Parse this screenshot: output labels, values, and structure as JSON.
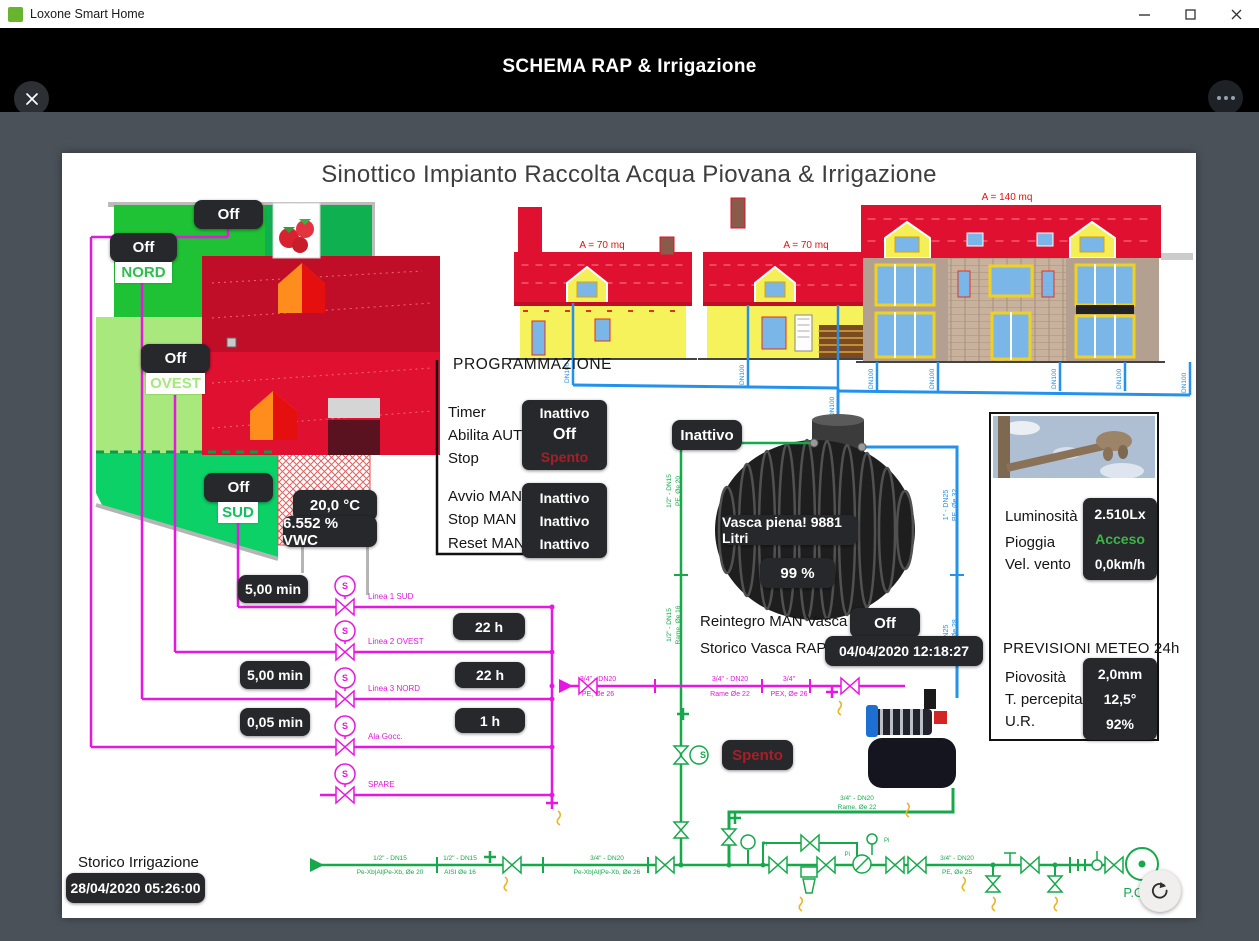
{
  "window": {
    "title": "Loxone Smart Home"
  },
  "header": {
    "title": "SCHEMA RAP & Irrigazione"
  },
  "canvas": {
    "title": "Sinottico Impianto Raccolta Acqua Piovana & Irrigazione",
    "map": {
      "top_state": "Off",
      "nord_state": "Off",
      "nord_label": "NORD",
      "ovest_state": "Off",
      "ovest_label": "OVEST",
      "sud_state": "Off",
      "sud_label": "SUD",
      "soil_temp": "20,0 °C",
      "soil_vwc": "6.552 % VWC"
    },
    "houses": {
      "area_small_1": "A = 70 mq",
      "area_small_2": "A = 70 mq",
      "area_large": "A = 140 mq",
      "downpipe_label": "DN100"
    },
    "program": {
      "title": "PROGRAMMAZIONE",
      "timer_label": "Timer",
      "timer_value": "Inattivo",
      "auto_label": "Abilita AUTO",
      "auto_value": "Off",
      "stop_label": "Stop",
      "stop_value": "Spento",
      "avvio_label": "Avvio MAN",
      "avvio_value": "Inattivo",
      "stopman_label": "Stop MAN",
      "stopman_value": "Inattivo",
      "reset_label": "Reset MAN",
      "reset_value": "Inattivo"
    },
    "tank": {
      "inlet_state": "Inattivo",
      "level_text": "Vasca piena! 9881 Litri",
      "level_percent": "99 %",
      "reintegro_label": "Reintegro MAN Vasca",
      "reintegro_value": "Off",
      "storico_label": "Storico Vasca RAP",
      "storico_value": "04/04/2020 12:18:27"
    },
    "weather": {
      "lum_label": "Luminosità",
      "lum_value": "2.510Lx",
      "rain_label": "Pioggia",
      "rain_value": "Acceso",
      "wind_label": "Vel. vento",
      "wind_value": "0,0km/h",
      "forecast_title": "PREVISIONI METEO 24h",
      "rain24_label": "Piovosità",
      "rain24_value": "2,0mm",
      "temp_label": "T. percepita",
      "temp_value": "12,5°",
      "hum_label": "U.R.",
      "hum_value": "92%"
    },
    "irrigation": {
      "valve_letter": "S",
      "line1": "Linea 1 SUD",
      "line2": "Linea 2 OVEST",
      "line3": "Linea 3 NORD",
      "line4": "Ala Gocc.",
      "line5": "SPARE",
      "dur1": "5,00 min",
      "cnt1": "22 h",
      "dur3": "5,00 min",
      "cnt3": "22 h",
      "dur4": "0,05 min",
      "cnt4": "1 h",
      "pump_state": "Spento"
    },
    "pipes": {
      "gauge": "Pi",
      "tank_in_a1": "1/2\" - DN15",
      "tank_in_a2": "PE, Øe 20",
      "tank_in_b1": "1/2\" - DN15",
      "tank_in_b2": "Rame, Øe 16",
      "tank_out_a1": "1\" - DN25",
      "tank_out_a2": "PE, Øe 32",
      "tank_out_b1": "1\" - DN25",
      "tank_out_b2": "Rame, Øe 28",
      "main_a1": "3/4\" - DN20",
      "main_a2": "PE, Øe 26",
      "main_b1": "3/4\" - DN20",
      "main_b2": "Rame Øe 22",
      "main_c1": "3/4\"",
      "main_c2": "PEX, Øe 26",
      "pump_out1": "3/4\" - DN20",
      "pump_out2": "Rame, Øe 22",
      "bot_a1": "1/2\" - DN15",
      "bot_a2": "Pe-Xb|Al|Pe-Xb, Øe 20",
      "bot_b1": "1/2\" - DN15",
      "bot_b2": "AISI Øe 16",
      "bot_c1": "3/4\" - DN20",
      "bot_c2": "Pe-Xb|Al|Pe-Xb, Øe 26",
      "bot_d1": "3/4\" - DN20",
      "bot_d2": "PE, Øe 25"
    },
    "history": {
      "label": "Storico Irrigazione",
      "value": "28/04/2020 05:26:00"
    },
    "pod_label": "P.O.D."
  }
}
